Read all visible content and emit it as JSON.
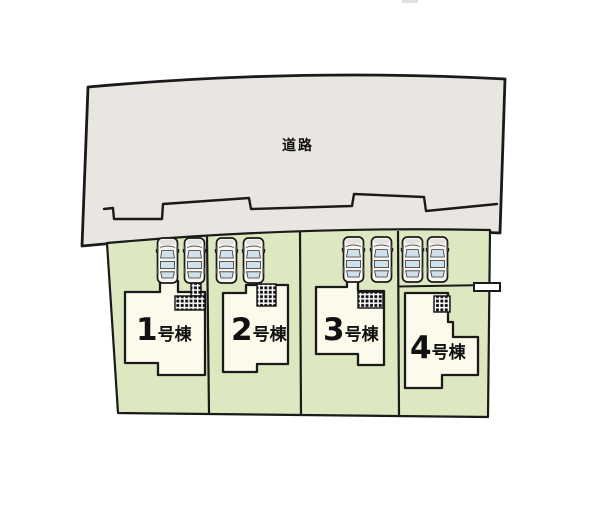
{
  "plan": {
    "road": {
      "label": "道路"
    },
    "houses": [
      {
        "label": "1号棟",
        "number": "1",
        "suffix": "号棟"
      },
      {
        "label": "2号棟",
        "number": "2",
        "suffix": "号棟"
      },
      {
        "label": "3号棟",
        "number": "3",
        "suffix": "号棟"
      },
      {
        "label": "4号棟",
        "number": "4",
        "suffix": "号棟"
      }
    ],
    "parking": {
      "cars_per_lot": 2,
      "total_cars": 8
    },
    "colors": {
      "road": "#e9e6e2",
      "lot": "#dde8c1",
      "house": "#fcfaea",
      "car_body": "#f7f6f1",
      "car_window": "#cfe2ec",
      "outline": "#1a1a1a"
    }
  }
}
